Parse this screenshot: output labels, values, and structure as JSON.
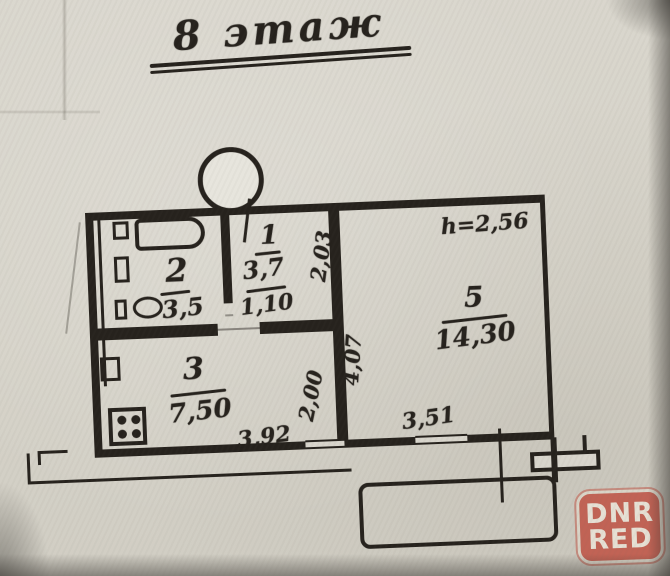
{
  "title": "8 этаж",
  "ceiling_height_label": "h=2,56",
  "rooms": [
    {
      "id": "bathroom",
      "number": "2",
      "area": "3,5"
    },
    {
      "id": "hallway",
      "number": "1",
      "area": "3,7",
      "dim_width": "1,10",
      "dim_depth": "2,03"
    },
    {
      "id": "kitchen",
      "number": "3",
      "area": "7,50",
      "dim_width": "3,92",
      "dim_depth": "2,00"
    },
    {
      "id": "living-room",
      "number": "5",
      "area": "14,30",
      "dim_width": "3,51",
      "dim_depth": "4,07"
    }
  ],
  "watermark": {
    "line1": "DNR",
    "line2": "RED",
    "color": "#c05849"
  },
  "colors": {
    "paper": "#d7d4ca",
    "ink": "#26221d"
  }
}
